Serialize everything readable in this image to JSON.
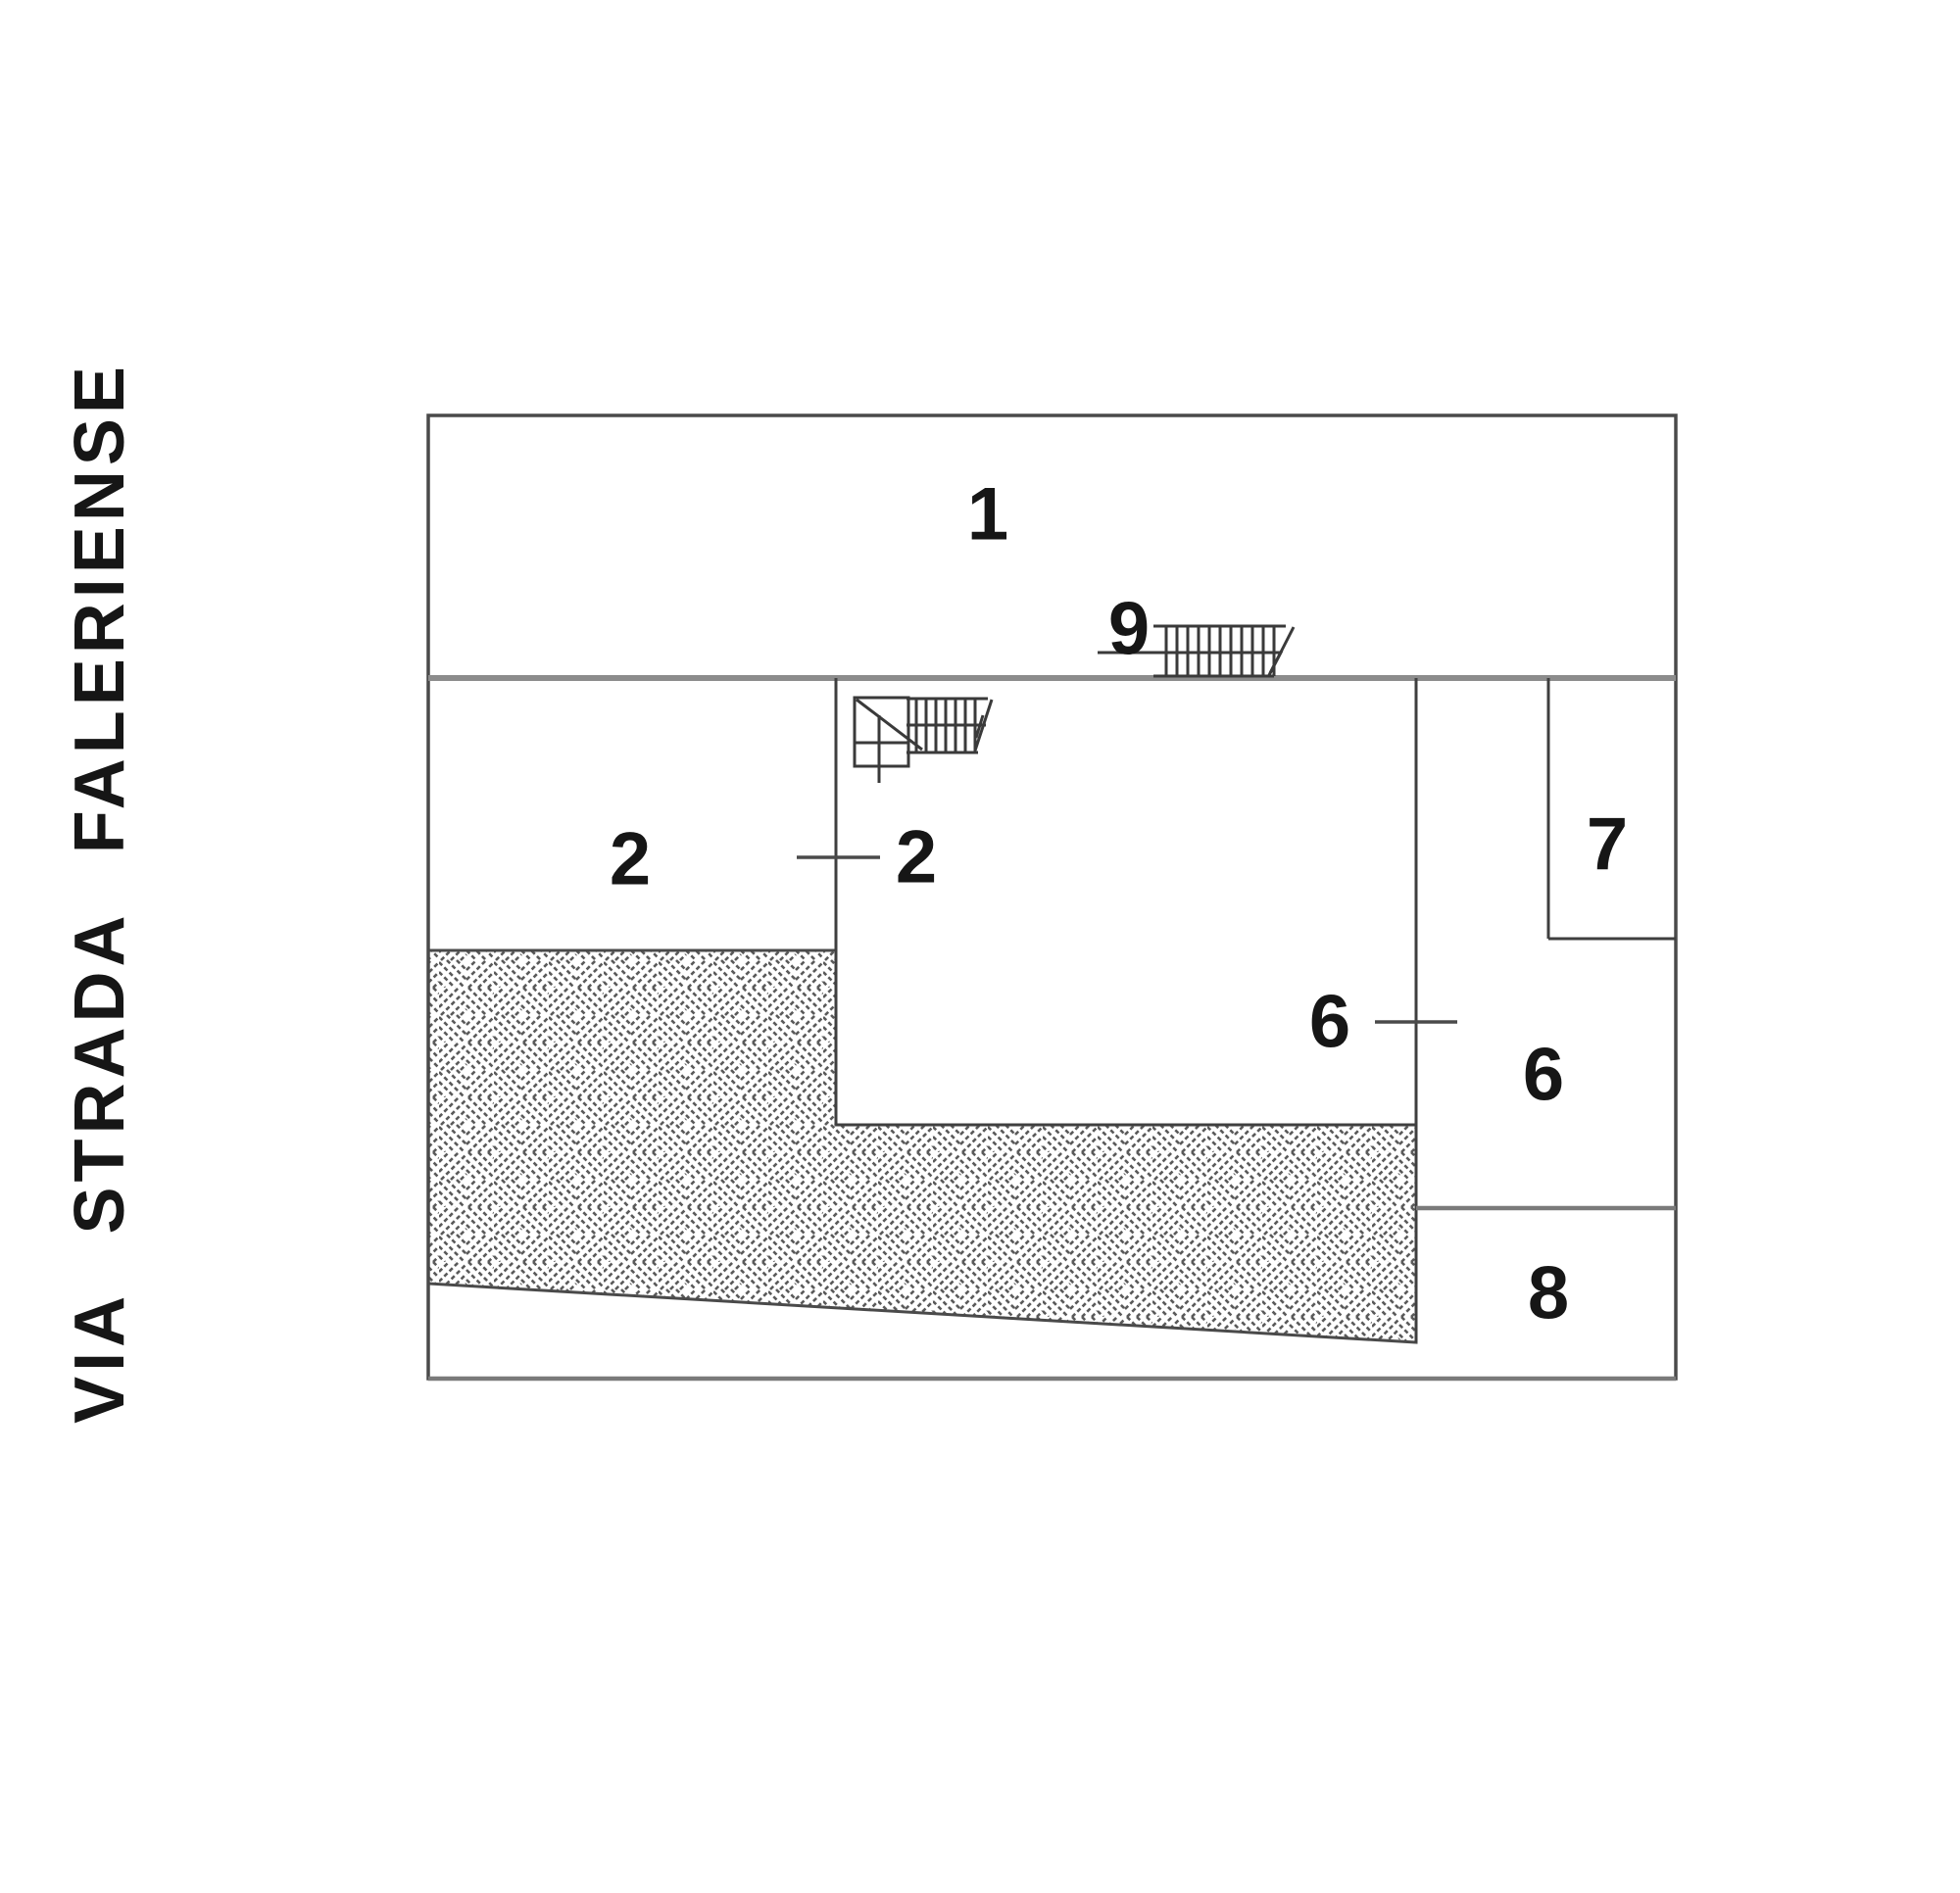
{
  "street": {
    "name": "VIA STRADA FALERIENSE"
  },
  "colors": {
    "background": "#ffffff",
    "line": "#3f3f3f",
    "thick_divider": "#8c8c8c",
    "text": "#161616"
  },
  "parcel_labels": [
    {
      "id": "parcel-1",
      "text": "1"
    },
    {
      "id": "parcel-2-left",
      "text": "2"
    },
    {
      "id": "parcel-2-right",
      "text": "2"
    },
    {
      "id": "stair-9",
      "text": "9"
    },
    {
      "id": "parcel-6-inner",
      "text": "6"
    },
    {
      "id": "parcel-6-right",
      "text": "6"
    },
    {
      "id": "parcel-7",
      "text": "7"
    },
    {
      "id": "parcel-8",
      "text": "8"
    }
  ]
}
